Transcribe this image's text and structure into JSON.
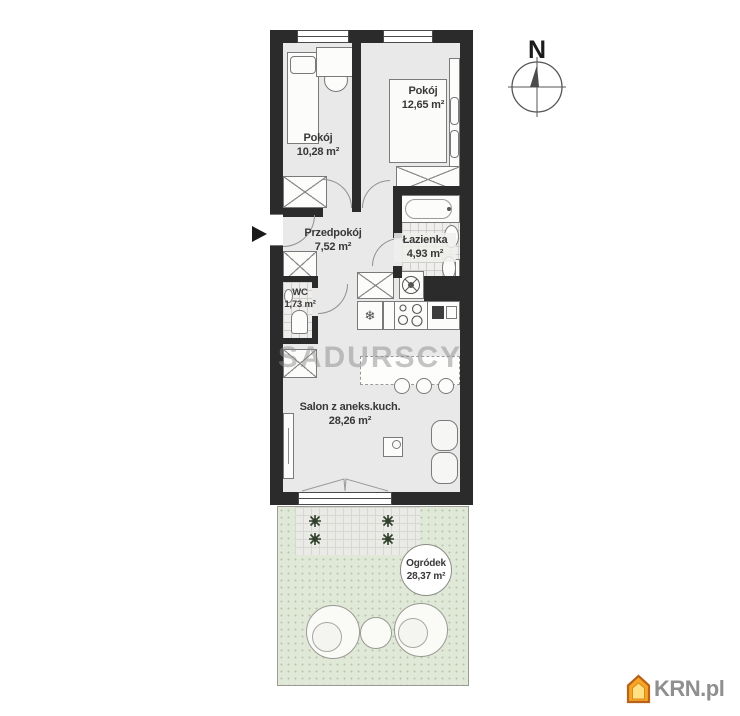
{
  "floorplan": {
    "watermark": "SADURSCY",
    "compass": {
      "label": "N"
    },
    "rooms": {
      "bedroom_small": {
        "name": "Pokój",
        "area": "10,28 m²"
      },
      "bedroom_large": {
        "name": "Pokój",
        "area": "12,65 m²"
      },
      "hallway": {
        "name": "Przedpokój",
        "area": "7,52 m²"
      },
      "bathroom": {
        "name": "Łazienka",
        "area": "4,93 m²"
      },
      "wc": {
        "name": "WC",
        "area": "1,73 m²"
      },
      "living_room": {
        "name": "Salon z aneks.kuch.",
        "area": "28,26 m²"
      },
      "garden": {
        "name": "Ogródek",
        "area": "28,37 m²"
      }
    },
    "glyphs": {
      "fridge_snowflake": "❄"
    },
    "colors": {
      "wall": "#2b2b2b",
      "floor": "#e9e9e9",
      "tile": "#efeeec",
      "garden_green": "#e0e8d7",
      "terrace_gray": "#eaeae6",
      "logo_orange": "#f6a623",
      "logo_text_gray": "#8f8f8f"
    }
  },
  "branding": {
    "logo_text": "KRN.pl"
  }
}
